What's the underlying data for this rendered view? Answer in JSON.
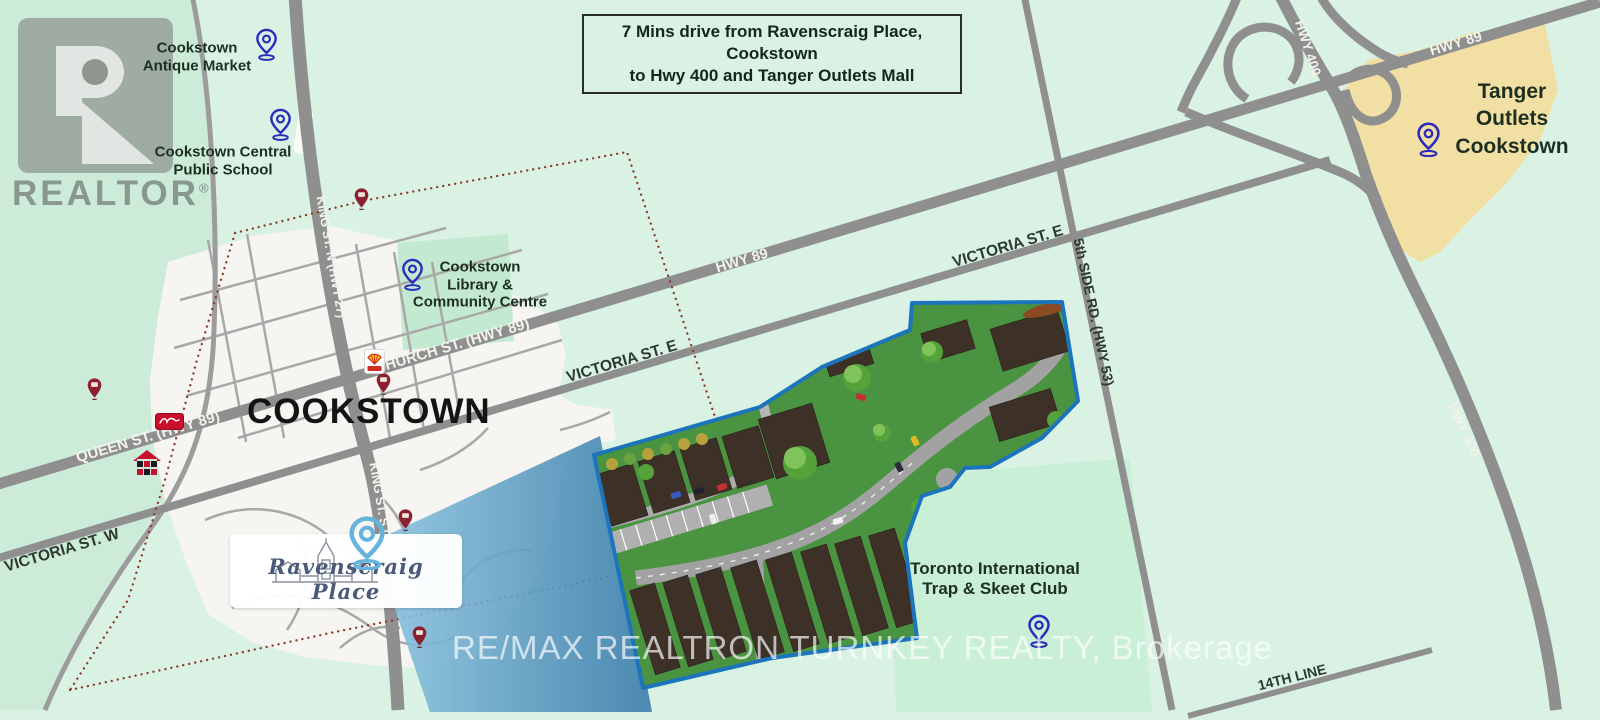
{
  "info_box": {
    "line1": "7 Mins drive from Ravenscraig Place, Cookstown",
    "line2": "to Hwy 400 and Tanger Outlets Mall"
  },
  "city": {
    "label": "COOKSTOWN"
  },
  "logo_box": {
    "name": "Ravenscraig Place"
  },
  "realtor": {
    "text": "REALTOR",
    "reg": "®"
  },
  "brokerage": {
    "text": "RE/MAX REALTRON TURNKEY REALTY, Brokerage"
  },
  "pois": {
    "antique_market": {
      "line1": "Cookstown",
      "line2": "Antique Market"
    },
    "public_school": {
      "line1": "Cookstown Central",
      "line2": "Public School"
    },
    "library": {
      "line1": "Cookstown",
      "line2": "Library &",
      "line3": "Community Centre"
    },
    "tanger": {
      "line1": "Tanger Outlets",
      "line2": "Cookstown"
    },
    "trap_skeet": {
      "line1": "Toronto International",
      "line2": "Trap & Skeet Club"
    }
  },
  "roads": {
    "queen": "QUEEN ST. (HWY 89)",
    "church": "CHURCH ST. (HWY 89)",
    "king_n": "KING ST. N (HWY 27)",
    "king_s": "KING ST. S (HWY 27)",
    "victoria_w": "VICTORIA ST. W",
    "victoria_e": "VICTORIA ST. E",
    "hwy89": "HWY 89",
    "hwy400": "HWY 400",
    "side_rd5": "5th SIDE RD. (HWY 53)",
    "line14": "14TH LINE"
  },
  "colors": {
    "background": "#d9f2e4",
    "road": "#8f8f8f",
    "town_area": "#f6f5f1",
    "park_green": "#c3ead0",
    "tanger_area": "#f1dfa3",
    "site_border_blue": "#1b74bc",
    "site_grass": "#4a9341",
    "view_cone_blue": "#4e8fba",
    "boundary_dotted": "#8a3c28",
    "pin_blue": "#2b2bbd",
    "pin_red": "#8c2030",
    "pin_light_blue": "#64b4dd"
  }
}
